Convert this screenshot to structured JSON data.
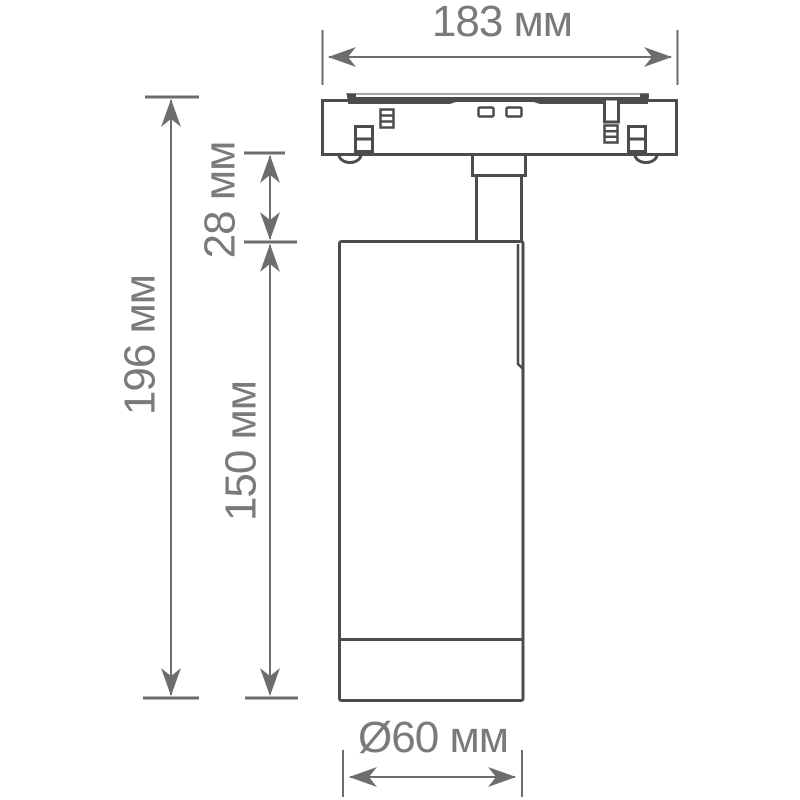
{
  "drawing": {
    "kind": "technical dimension drawing",
    "subject": "track-mounted cylindrical spotlight, side view"
  },
  "colors": {
    "background": "#ffffff",
    "fixture_outline": "#4c4c4c",
    "dimension_lines": "#6d6d6d",
    "dimension_text": "#7a7a7a"
  },
  "dimensions": {
    "track_width": {
      "label": "183 мм",
      "value_mm": 183
    },
    "total_height": {
      "label": "196 мм",
      "value_mm": 196
    },
    "stem_height": {
      "label": "28 мм",
      "value_mm": 28
    },
    "body_height": {
      "label": "150 мм",
      "value_mm": 150
    },
    "body_diameter": {
      "label": "Ø60 мм",
      "value_mm": 60
    }
  }
}
